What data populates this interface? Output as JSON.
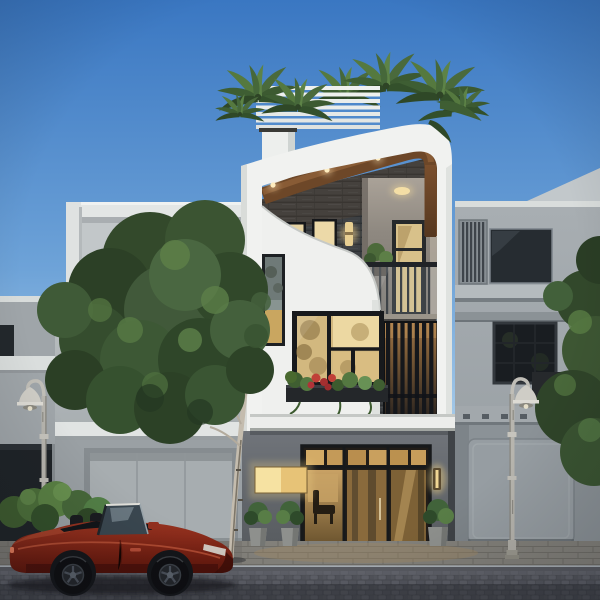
{
  "meta": {
    "title": "Modern three-storey townhouse exterior - dusk architectural render",
    "type": "architectural-visualization",
    "canvas": "600x600"
  },
  "palette": {
    "sky_top": "#3a77c2",
    "sky_horizon": "#d9e9f4",
    "facade_white": "#f1f2f0",
    "slate_cladding": "#3d4043",
    "timber_soffit": "#6d4728",
    "timber_slats": "#8a6a42",
    "warm_light": "#e8d09a",
    "neighbor_grey": "#a6adb2",
    "ground_floor_grey": "#636769",
    "sidewalk": "#82807a",
    "road_cobble": "#4c4e55",
    "car_red": "#8c2c1b",
    "foliage_green": "#3b5432"
  },
  "scene": {
    "sky": {
      "label": "clear gradient dusk sky"
    },
    "center_house": {
      "label": "three-storey modern townhouse",
      "roof": "white pergola louvers with rooftop palm trees",
      "fascia": "sweeping white curved fascia with timber soffit and three downlights",
      "top_floor": "dark slate-clad wall, two small lit windows, wall sconce, recessed balcony with glass railing, lit glass door and plant",
      "middle_floor": "white sculpted S-curve panel, narrow art window, black-framed picture window with flower box, vertical timber slat screen",
      "ground_floor": "dark grey wall, glass entrance with warm lit interior, illuminated signbox, wall sconce, three potted plants"
    },
    "left_house": "grey two-storey neighbour with white roof-deck frame, louvre screen, grid windows and garage",
    "far_left_house": "edge of another grey house with dark garage opening",
    "right_house": "grey neighbour with louvre panel, dark windows, equipment box and garage door, trees at edge",
    "street": {
      "surface": "dark cobblestone road with paver sidewalk and curb",
      "lamps": "two white vintage street lamps",
      "vehicle": "dark red convertible roadster parked facing right",
      "greenery": "tall leafy street tree on the left, bright hedge shrubs, rooftop palms"
    }
  }
}
